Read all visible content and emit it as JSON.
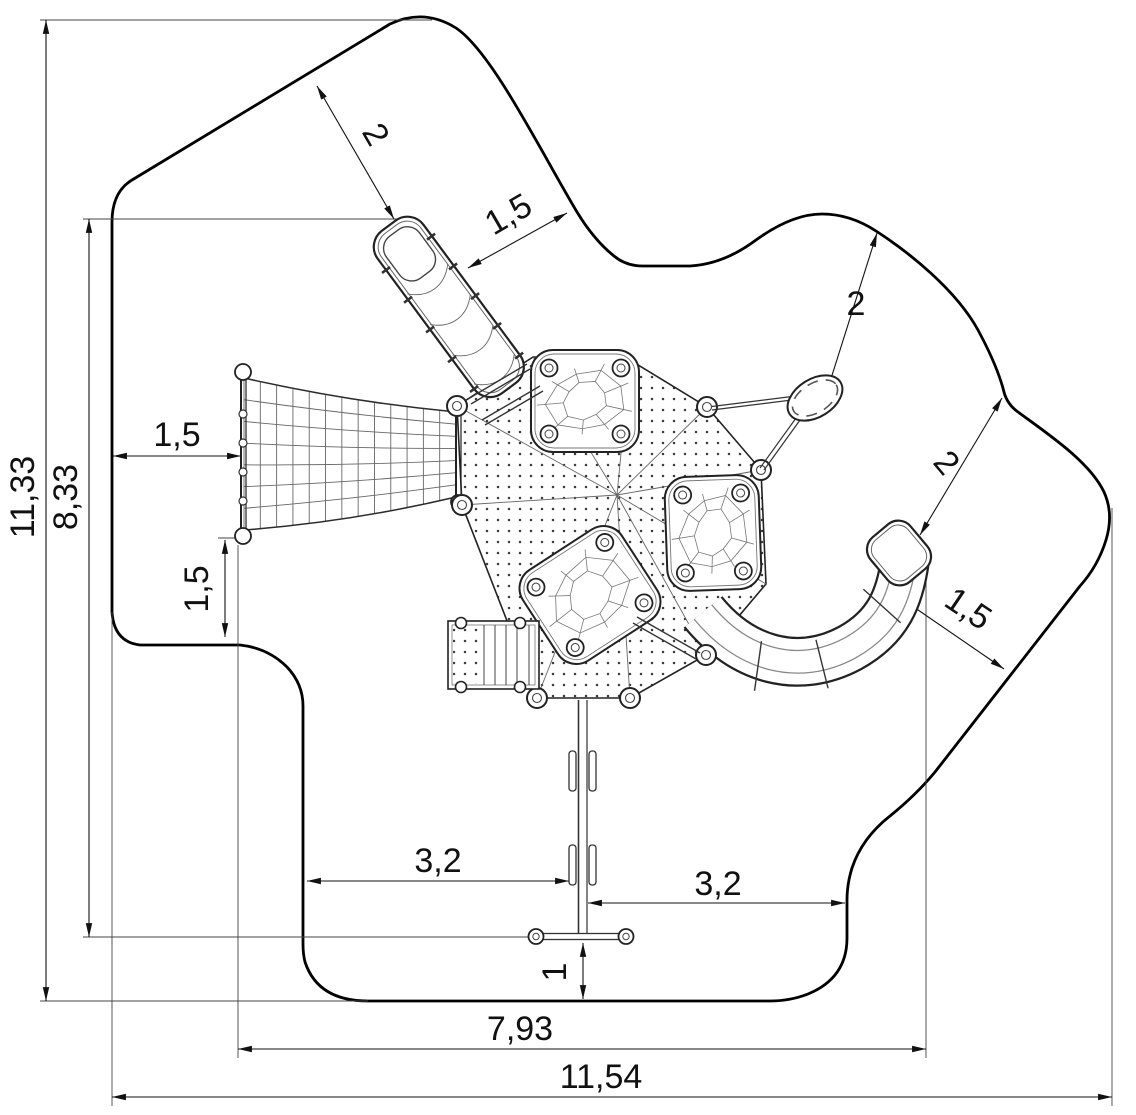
{
  "dimensions": [
    {
      "id": "total-height",
      "label": "11,33"
    },
    {
      "id": "equipment-height",
      "label": "8,33"
    },
    {
      "id": "slide-top-clearance",
      "label": "2"
    },
    {
      "id": "slide-side-clearance",
      "label": "1,5"
    },
    {
      "id": "spinner-clearance",
      "label": "2"
    },
    {
      "id": "curved-slide-top-clearance",
      "label": "2"
    },
    {
      "id": "curved-slide-side-clearance",
      "label": "1,5"
    },
    {
      "id": "net-left-clearance",
      "label": "1,5"
    },
    {
      "id": "net-bottom-clearance",
      "label": "1,5"
    },
    {
      "id": "swing-offset-left",
      "label": "3,2"
    },
    {
      "id": "swing-offset-right",
      "label": "3,2"
    },
    {
      "id": "swing-bottom-clearance",
      "label": "1"
    },
    {
      "id": "equipment-width",
      "label": "7,93"
    },
    {
      "id": "total-width",
      "label": "11,54"
    }
  ],
  "colors": {
    "line": "#111111",
    "background": "#ffffff"
  }
}
